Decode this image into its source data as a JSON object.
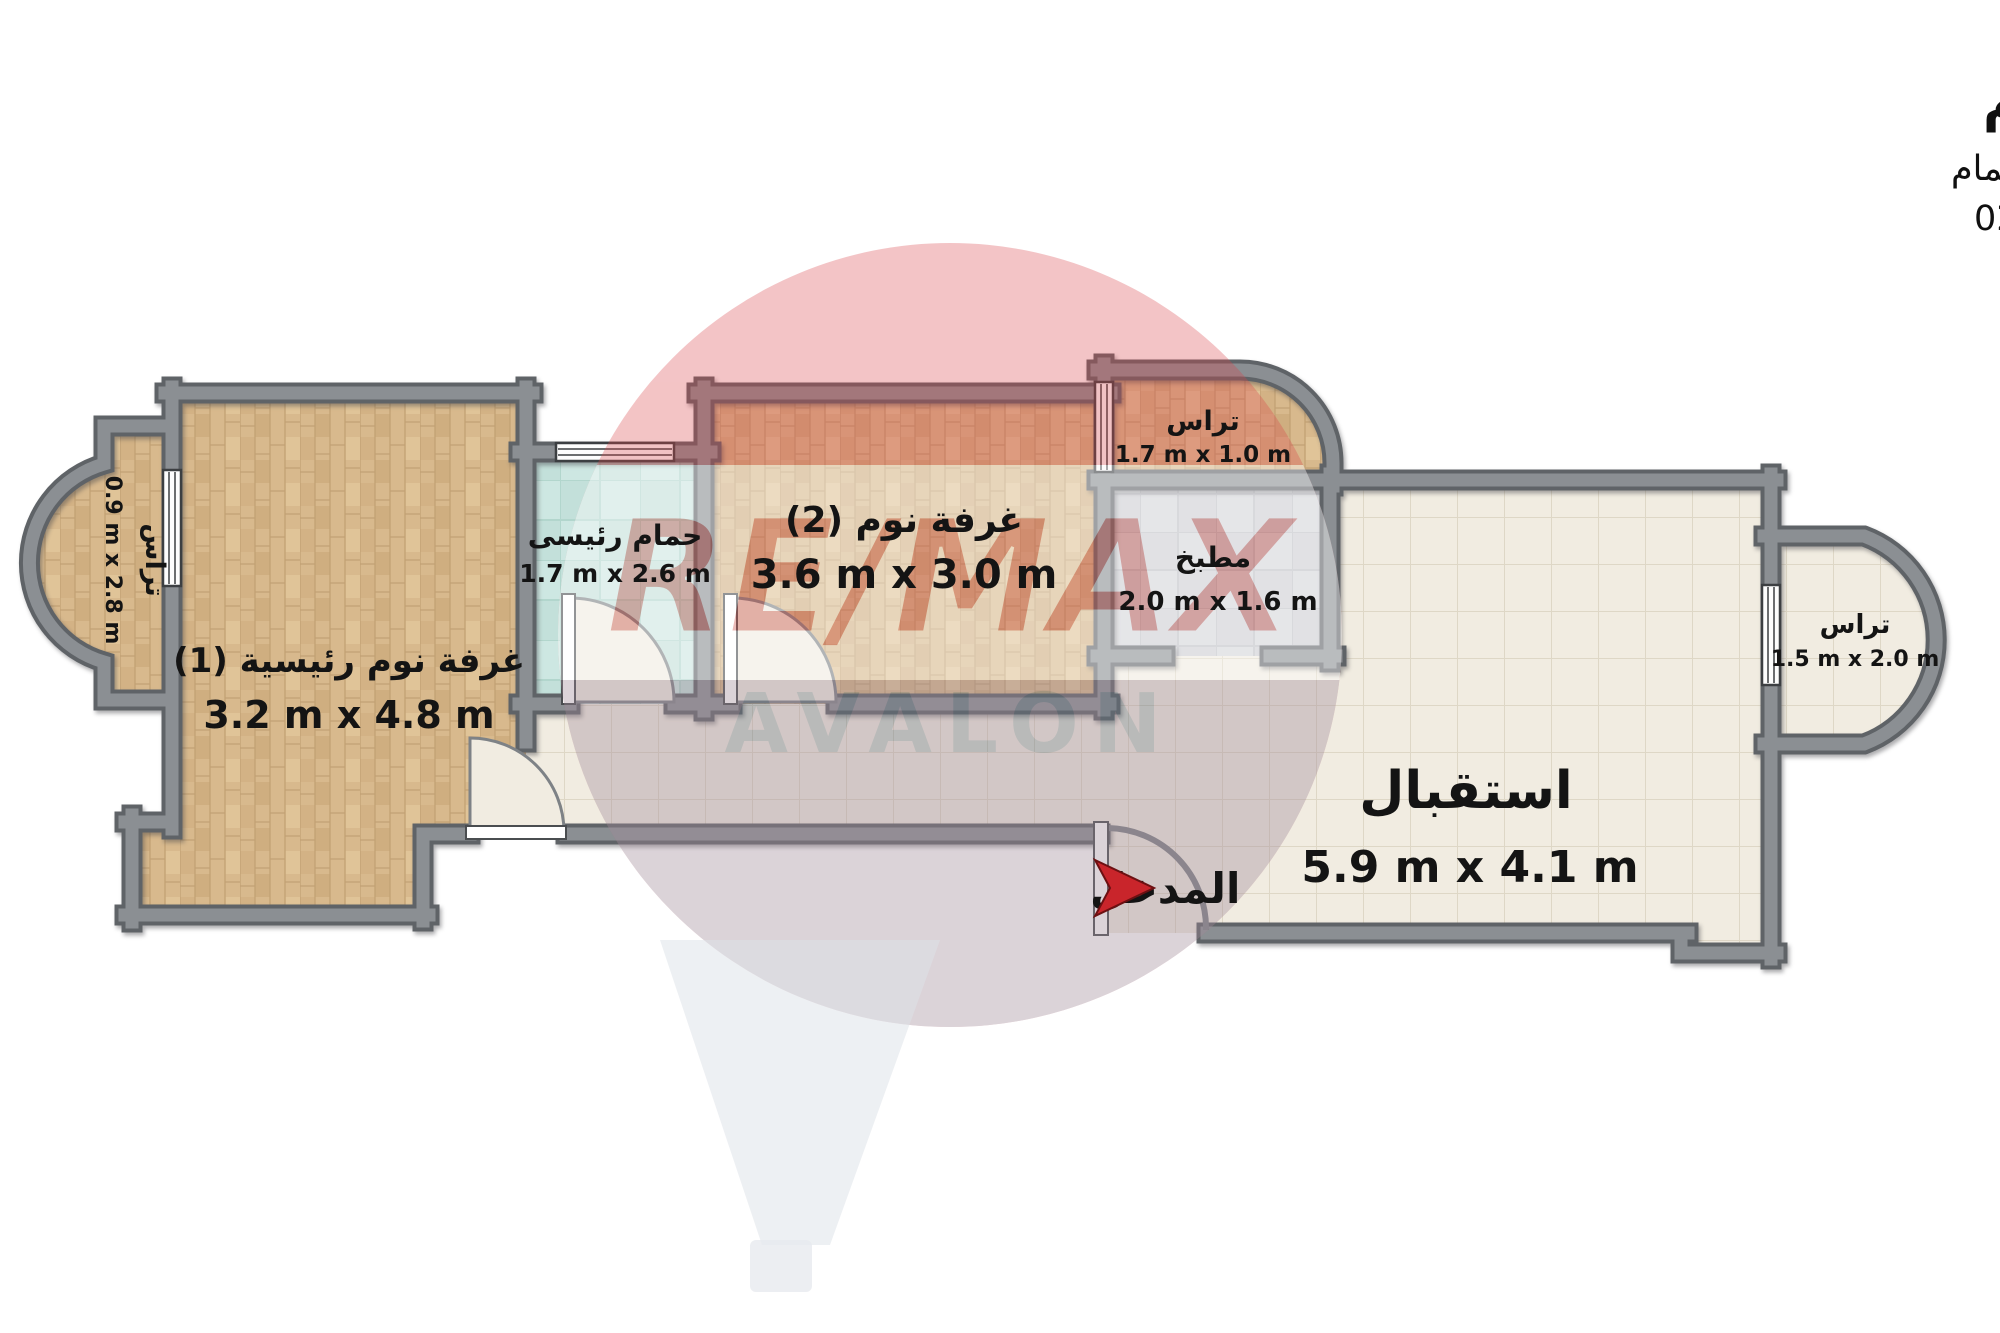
{
  "title": {
    "line1": "شاليه للبيع - الساحل الشمالي - كورال هيلز - 127 م",
    "line2": "2غرف + 2 رسيبشن + 1 حمام",
    "code_line": "كود : 021726"
  },
  "rooms": {
    "master_bedroom": {
      "name": "غرفة نوم رئيسية (1)",
      "dims": "3.2 m x 4.8 m"
    },
    "master_bathroom": {
      "name": "حمام رئيسى",
      "dims": "1.7 m x 2.6 m"
    },
    "bedroom2": {
      "name": "غرفة نوم (2)",
      "dims": "3.6 m x 3.0 m"
    },
    "kitchen": {
      "name": "مطبخ",
      "dims": "2.0 m x 1.6 m"
    },
    "reception": {
      "name": "استقبال",
      "dims": "5.9 m x 4.1 m"
    },
    "terrace_left": {
      "name": "تراس",
      "dims": "0.9 m x 2.8 m"
    },
    "terrace_top": {
      "name": "تراس",
      "dims": "1.7 m x 1.0 m"
    },
    "terrace_right": {
      "name": "تراس",
      "dims": "1.5 m x 2.0 m"
    },
    "entrance": {
      "name": "المدخل"
    }
  },
  "watermark": {
    "brand": "RE/MAX",
    "agency": "AVALON"
  },
  "colors": {
    "wall": "#84878b",
    "wall_outline": "#5f6367",
    "wood_floor": "#d8b98d",
    "bathroom_tile": "#cde7e2",
    "kitchen_tile": "#d5d6da",
    "reception_tile": "#f1ece1",
    "entrance_arrow_red": "#c9252b",
    "watermark_red": "#d94348",
    "watermark_blue_gray": "#8fa0b2",
    "label_text": "#141414"
  }
}
